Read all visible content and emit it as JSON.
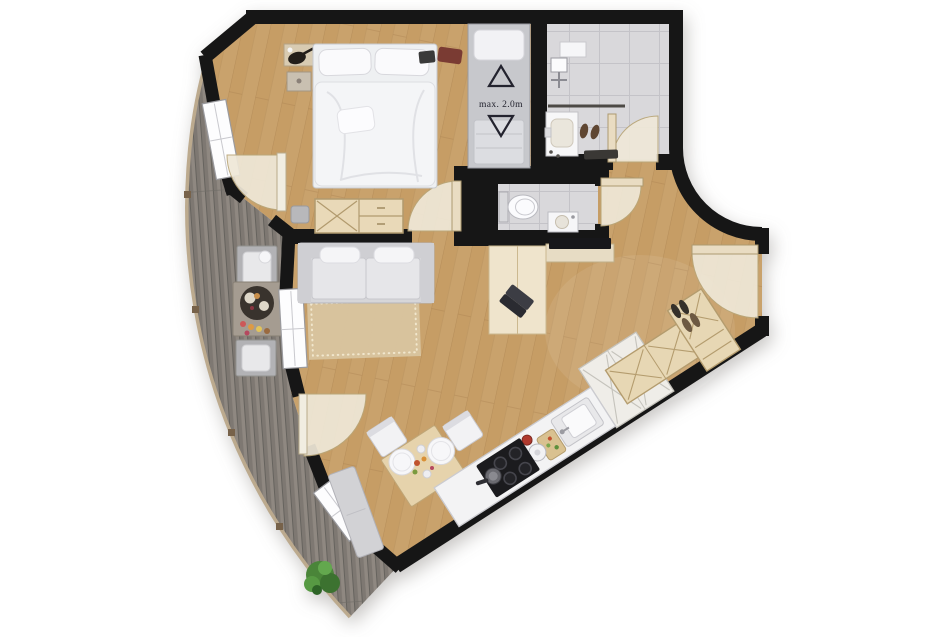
{
  "plan": {
    "type": "apartment-floor-plan",
    "labels": {
      "ceiling_height": "max. 2.0m"
    },
    "symbols": [
      {
        "name": "triangle-up-icon",
        "meaning": "outlined upward triangle printed beside ceiling-height note"
      },
      {
        "name": "triangle-down-icon",
        "meaning": "outlined downward triangle printed beside ceiling-height note"
      },
      {
        "name": "door-swing-arc",
        "meaning": "quarter-circle door swing symbol (6 doors)"
      }
    ],
    "colors": {
      "background": "#ffffff",
      "wall": "#161616",
      "wood_floor": "#c9a26c",
      "wood_floor_shade": "#b18a57",
      "deck": "#8f8881",
      "tile": "#d9d8db",
      "furniture_tan": "#e8d8b8",
      "door_arc": "#efe8d8",
      "sofa_gray": "#d8d8da",
      "rug": "#d9c5a0",
      "cooktop": "#1b1b1e",
      "plant_green": "#4a8539",
      "railing": "#bcaa8e"
    },
    "rooms": [
      {
        "id": "bedroom",
        "furniture": [
          "double-bed",
          "single-bed",
          "headboard-shelf",
          "nightstand",
          "dresser",
          "pouf"
        ]
      },
      {
        "id": "shower-room",
        "furniture": [
          "shower-fixture",
          "glass-screen",
          "vanity-sink",
          "slippers",
          "door-mat",
          "shelf"
        ]
      },
      {
        "id": "wc",
        "furniture": [
          "toilet",
          "hand-basin"
        ]
      },
      {
        "id": "living-area",
        "furniture": [
          "sofa",
          "rug",
          "tv",
          "tv-sideboard",
          "desk",
          "laptop"
        ]
      },
      {
        "id": "dining-area",
        "furniture": [
          "dining-table",
          "dining-chair",
          "dining-chair",
          "bench",
          "plates",
          "food"
        ]
      },
      {
        "id": "kitchen",
        "furniture": [
          "counter",
          "sink",
          "cooktop",
          "pan",
          "kettle",
          "cutting-board",
          "tall-cabinets"
        ]
      },
      {
        "id": "entrance",
        "furniture": [
          "entry-door",
          "l-shaped-wardrobe",
          "shoes"
        ]
      },
      {
        "id": "balcony",
        "furniture": [
          "lounge-chair",
          "side-table",
          "serving-tray",
          "pastries",
          "lounge-chair",
          "plant",
          "railing"
        ]
      }
    ],
    "openings": {
      "windows": 3,
      "doors": 6
    }
  }
}
